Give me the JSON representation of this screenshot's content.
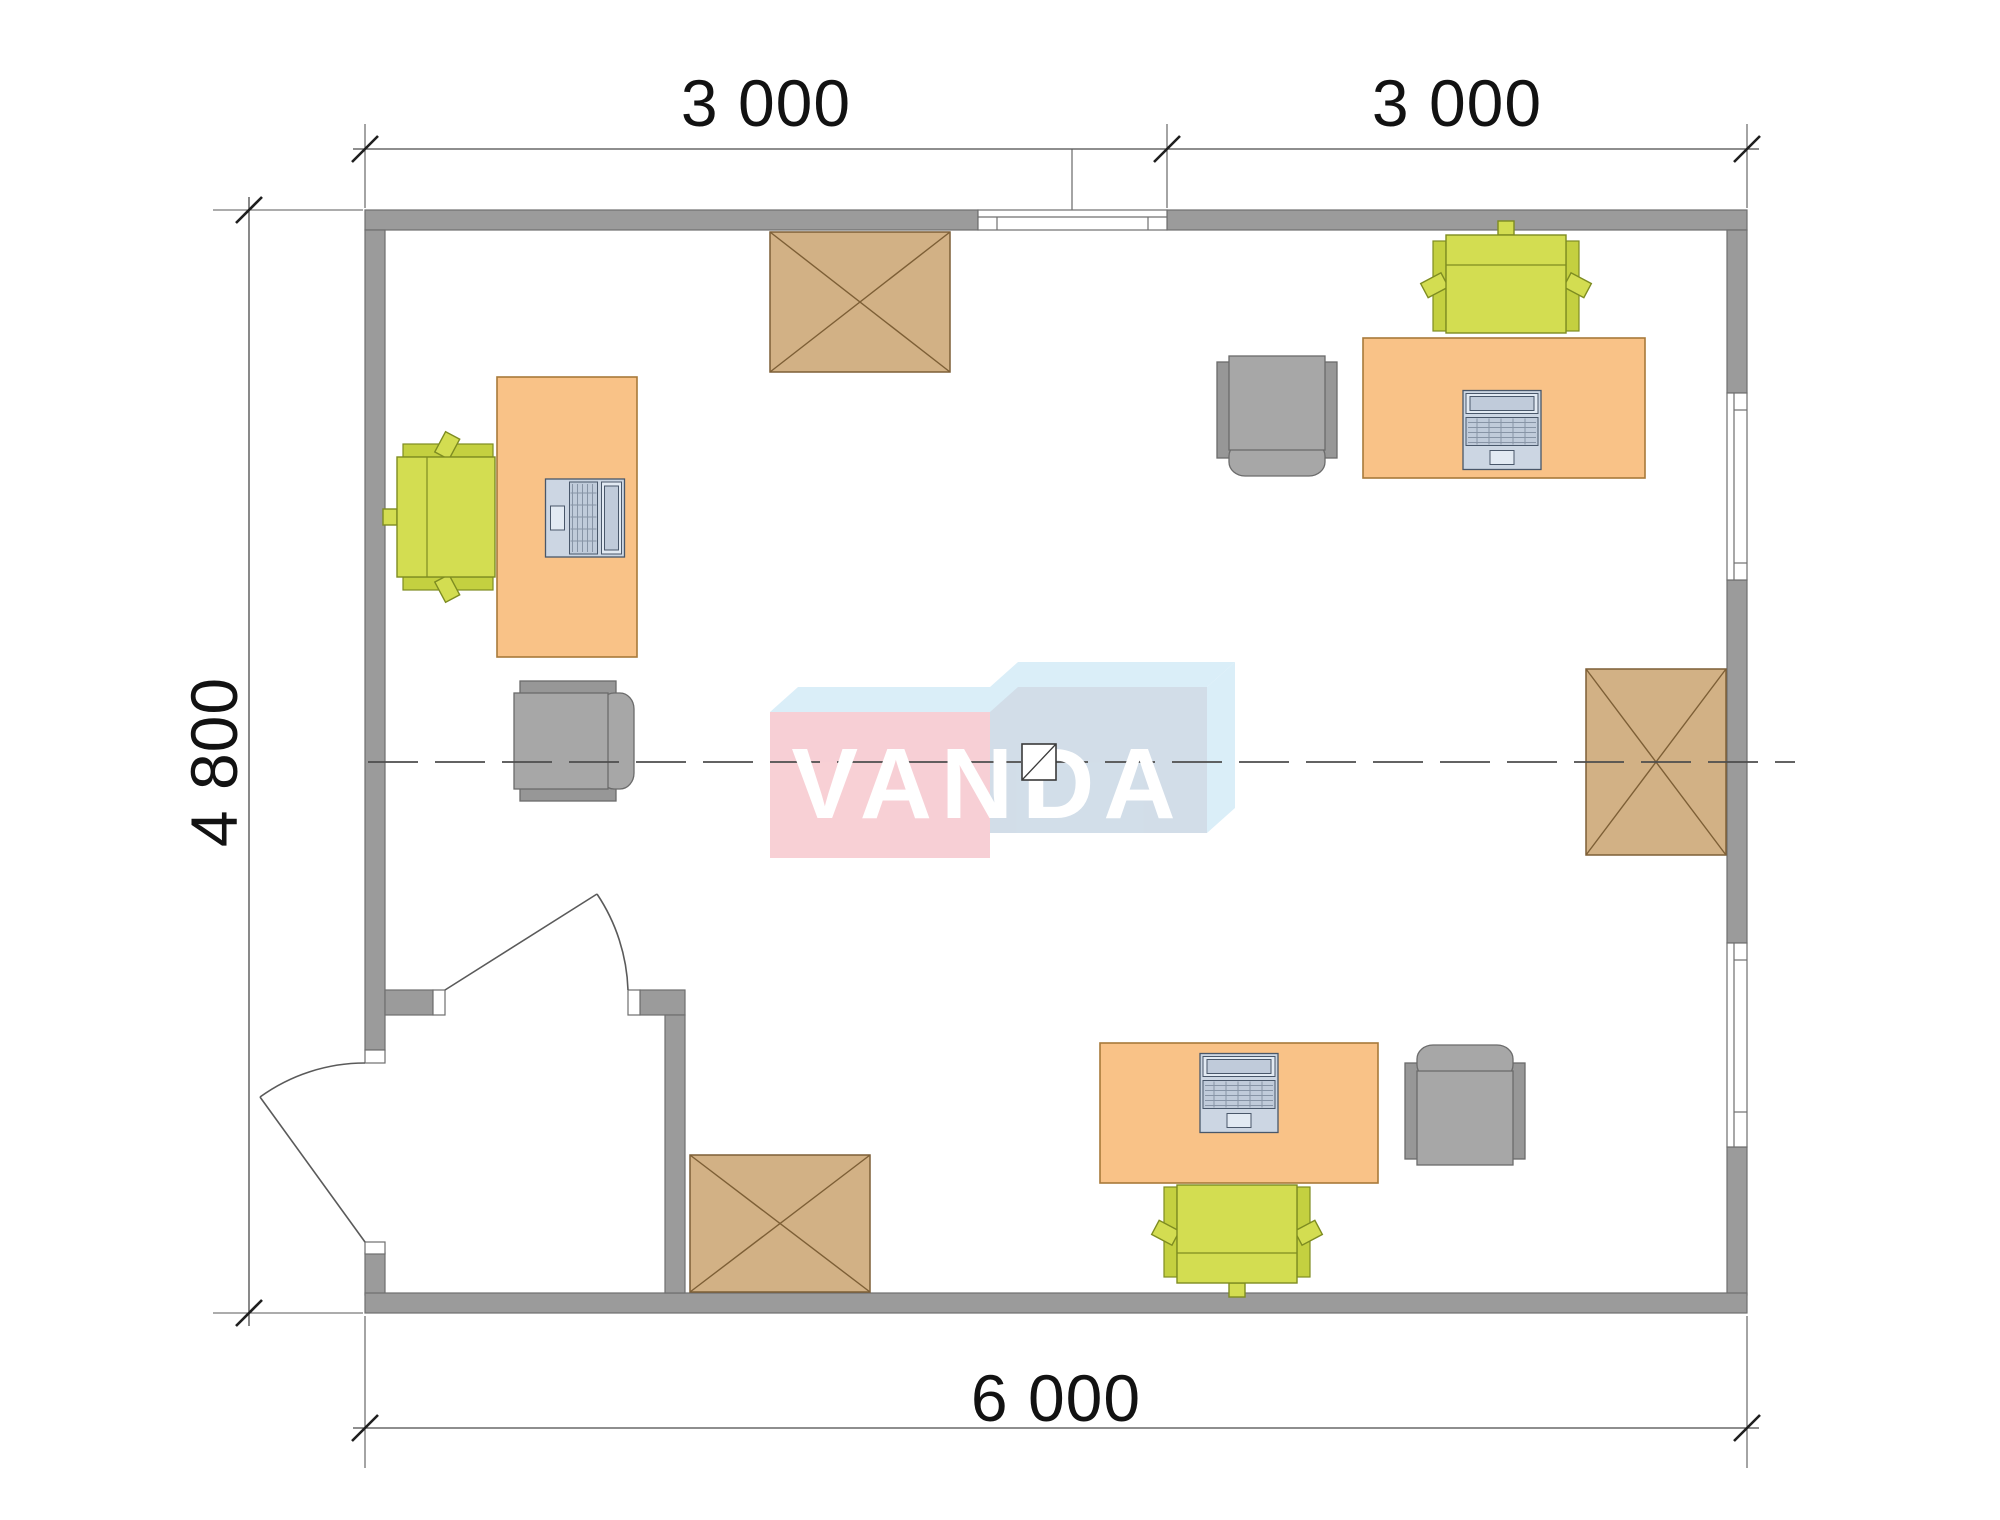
{
  "plan": {
    "watermark_text": "VANDA",
    "dim_top_left": "3 000",
    "dim_top_right": "3 000",
    "dim_left": "4 800",
    "dim_bottom": "6 000"
  },
  "colors": {
    "wall": "#9b9b9b",
    "desk": "#f9c287",
    "chair_green": "#d3dd51",
    "armchair_gray": "#a6a6a6",
    "table_tan": "#d2b185",
    "laptop_blue": "#ccd6e3",
    "watermark_pink": "#f7ccd2",
    "watermark_blue": "#cfdbe7",
    "watermark_sky": "#d8edf8",
    "axis_gray": "#4d4d4d"
  }
}
